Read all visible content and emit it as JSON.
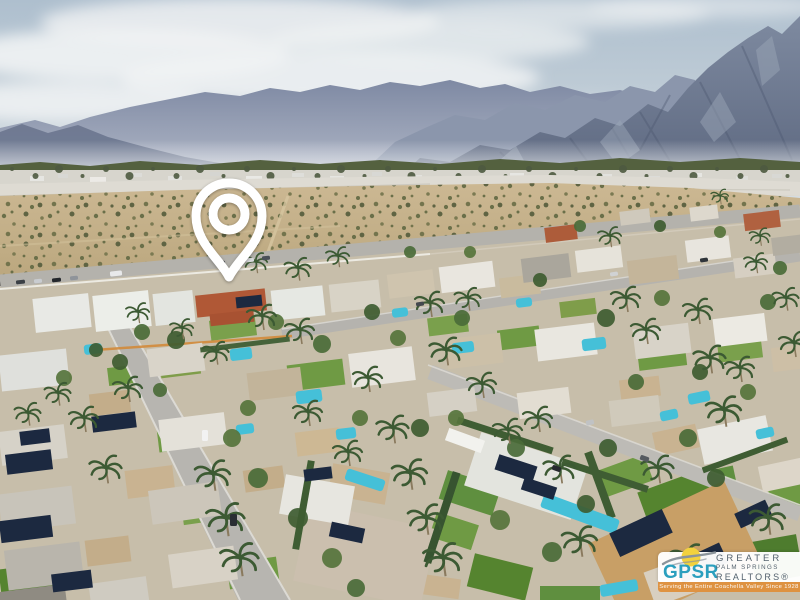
{
  "scene": {
    "type": "aerial-photograph",
    "description": "Oblique drone view of a Palm Springs neighborhood: desert scrub field and sandy wash in the midground, hazy San Jacinto mountains and clouds behind, streets with mid-century homes, pools, palms and solar roofs below. A white outline location pin marks a home with a red tile roof.",
    "palette": {
      "sky": "#b6c3cf",
      "clouds": "#f1f3f4",
      "mountains_far": "#8a94ab",
      "mountains_near": "#6d7890",
      "big_mountain": "#6b7690",
      "treeline": "#54613f",
      "valley_sand": "#dedbd3",
      "desert": "#c4b089",
      "scrub_dots": "#6a6f49",
      "roads": "#b5b3ae",
      "roof_white": "#e9e6df",
      "roof_terracotta": "#b05836",
      "lawn": "#6f9a44",
      "pool": "#45c0d8",
      "solar_panel": "#1c2940",
      "palm": "#3c5a33"
    }
  },
  "map_marker": {
    "icon": "location-pin-icon",
    "color": "#ffffff"
  },
  "watermark": {
    "acronym": "GPSR",
    "org_lines": [
      "GREATER",
      "PALM SPRINGS",
      "REALTORS®"
    ],
    "tagline": "Serving the Entire Coachella Valley Since 1928",
    "colors": {
      "acronym_teal": "#2b9fbe",
      "org_gray": "#54626e",
      "tagline_bar": "#e0903c",
      "tagline_text": "#ffffff",
      "sun_yellow": "#f2d13e",
      "swoosh_gray": "#8b949b",
      "box_white": "#ffffff"
    }
  }
}
